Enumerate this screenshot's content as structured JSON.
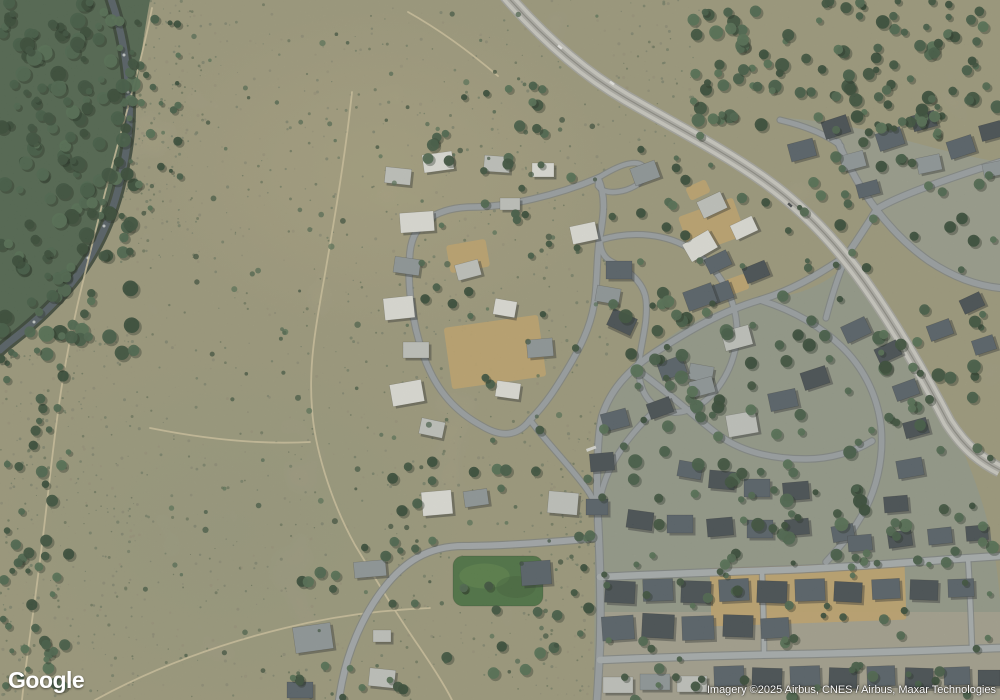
{
  "overlay": {
    "logo": "Google",
    "attribution": "Imagery ©2025 Airbus, CNES / Airbus, Maxar Technologies"
  },
  "map": {
    "width": 1000,
    "height": 700,
    "palette": {
      "scrub_base": "#ada789",
      "speckle": [
        "#79816b",
        "#8a8a74",
        "#657059",
        "#97927b",
        "#6e7a64"
      ],
      "forest_base": "#49614b",
      "tree_greens": [
        "#3a5540",
        "#314a37",
        "#44614a",
        "#2b4230",
        "#4c6a50"
      ],
      "river_water": "#4e5a64",
      "river_bank": "#2c3a30",
      "trail": "#d6c9a4",
      "dirt_lot": "#c4a76f",
      "field_green": "#45703f",
      "field_light": "#5f8c4d",
      "road_fill": "#9aa1a9",
      "road_fill_light": "#aab0b6",
      "road_casing": "#767d85",
      "highway_fill": "#d0d0cc",
      "highway_casing": "#a8a8a4",
      "highway_center": "#b2b2ae",
      "highway_line": "#8c8c88",
      "house_colors": [
        "#e8e9e5",
        "#c6cac8",
        "#8f989e",
        "#505c68",
        "#3d4750",
        "#c9ad76"
      ],
      "house_shadow": "rgba(25,30,35,0.4)",
      "vehicle_light": "#f2f2f2",
      "vehicle_dark": "#3e434a"
    },
    "ground": [
      {
        "path": "M 594,700 L 595,540 C 594,480 597,440 606,414 C 618,382 640,358 668,338 C 700,315 736,302 772,298 C 806,294 832,280 846,264 C 870,290 894,326 920,368 C 944,408 966,452 980,496 C 992,532 998,570 1000,600 L 1000,700 Z",
        "fill": "#949a8d",
        "opacity": 0.95
      },
      {
        "path": "M 788,118 C 830,122 870,130 905,140 C 940,150 975,158 1000,162 L 1000,285 C 975,282 950,273 926,259 C 905,246 888,228 874,210 C 862,190 850,166 838,144 Z",
        "fill": "#9aa092",
        "opacity": 0.9
      },
      {
        "path": "M 598,612 L 1000,612 L 1000,700 L 598,700 Z",
        "fill": "#a9a494",
        "opacity": 0.85
      }
    ],
    "forest": {
      "path": "M 0,0 L 150,0 C 142,42 138,88 128,130 C 119,166 111,200 97,236 C 84,268 60,296 36,318 C 20,333 8,344 0,352 Z",
      "fill": "#49614b"
    },
    "river": {
      "path": "M 110,-4 C 122,30 127,62 129,96 C 131,128 126,158 118,190 C 111,216 100,242 84,266 C 68,290 44,314 22,332 C 12,340 4,346 0,350",
      "water_width": 7,
      "bank_width": 13,
      "rapids": [
        [
          113,
          18
        ],
        [
          124,
          55
        ],
        [
          128,
          92
        ],
        [
          124,
          140
        ],
        [
          116,
          182
        ],
        [
          104,
          226
        ],
        [
          88,
          258
        ],
        [
          60,
          296
        ],
        [
          34,
          322
        ]
      ]
    },
    "trails": [
      "M 152,8 C 140,70 118,140 102,205 C 88,262 72,320 62,385 C 53,440 48,500 40,560 C 34,610 26,660 22,700",
      "M 352,92 C 346,150 336,210 326,268 C 318,315 308,360 312,408 C 314,445 330,500 355,545 C 375,578 395,612 420,648 C 432,666 444,684 452,700",
      "M 95,700 C 150,670 215,645 285,628 C 330,617 380,610 430,608",
      "M 150,428 C 200,438 255,445 310,442",
      "M 408,12 C 440,30 470,52 498,76"
    ],
    "dirt_lots": [
      [
        495,
        352,
        95,
        62,
        -8
      ],
      [
        712,
        226,
        58,
        40,
        -20
      ],
      [
        733,
        286,
        30,
        16,
        -20
      ],
      [
        698,
        190,
        22,
        14,
        -25
      ],
      [
        808,
        594,
        195,
        58,
        -2
      ],
      [
        468,
        256,
        40,
        28,
        -10
      ]
    ],
    "field": {
      "x": 453,
      "y": 556,
      "w": 90,
      "h": 50,
      "rx": 10
    },
    "roads": {
      "minor": [
        {
          "p": "M 598,178 C 556,196 505,207 474,207 C 441,207 413,220 410,252 C 407,282 411,320 424,357 C 437,393 458,413 482,426 C 502,438 518,436 530,420 C 546,404 556,388 568,368 C 580,348 590,328 594,305 C 598,282 596,258 600,236 C 604,214 606,196 598,178 Z",
          "w": 5.5
        },
        {
          "p": "M 598,178 C 614,168 634,158 643,166 C 651,174 641,185 626,190 C 612,194 602,192 598,186 Z",
          "w": 4.5
        },
        {
          "p": "M 530,420 C 548,444 570,466 586,488 C 594,499 597,508 598,520",
          "w": 5
        },
        {
          "p": "M 600,240 C 634,230 668,234 692,250 C 716,266 732,292 736,318 C 740,344 732,370 716,390 C 700,410 676,418 658,408 C 642,398 636,378 640,355 C 643,336 648,318 646,300 C 644,282 628,270 612,262 C 604,258 600,250 600,240",
          "w": 5
        },
        {
          "p": "M 658,408 C 640,424 618,448 606,478 C 600,494 598,506 598,520",
          "w": 5
        },
        {
          "p": "M 598,538 C 556,542 500,546 464,546 C 428,546 404,562 384,588 C 362,616 348,652 342,682 C 340,692 339,700 339,700",
          "w": 6,
          "f": "#a4abb2"
        },
        {
          "p": "M 598,520 C 600,560 601,610 600,645 C 599,668 598,685 597,700",
          "w": 6.5
        },
        {
          "p": "M 840,260 C 816,276 790,291 760,300 C 722,311 688,331 654,353 C 627,371 610,391 602,416 C 598,432 597,458 597,490 C 597,500 598,510 598,520",
          "w": 6
        },
        {
          "p": "M 760,300 C 792,310 820,326 841,346 C 862,366 877,393 881,426 C 884,458 877,492 859,520 C 849,537 836,551 826,562",
          "w": 5.5
        },
        {
          "p": "M 640,372 C 668,392 698,420 720,436 C 744,453 774,459 806,459 C 830,459 854,452 872,441",
          "w": 5.5
        },
        {
          "p": "M 600,577 C 660,574 720,572 780,570 C 840,568 900,563 955,559 C 970,558 986,557 1000,556",
          "w": 6.5,
          "f": "#aab0b6"
        },
        {
          "p": "M 600,660 C 668,657 736,655 804,654 C 870,653 936,650 1000,648",
          "w": 6.5,
          "f": "#aab0b6"
        },
        {
          "p": "M 762,571 C 763,600 764,628 764,655",
          "w": 4.5,
          "f": "#aab0b6"
        },
        {
          "p": "M 968,558 C 970,590 971,620 972,648",
          "w": 4.5,
          "f": "#aab0b6"
        },
        {
          "p": "M 838,142 C 850,170 862,191 876,209 C 891,229 909,247 929,261 C 956,279 980,286 1000,288",
          "w": 6
        },
        {
          "p": "M 845,258 C 860,236 869,222 877,209 C 896,197 940,181 1000,162",
          "w": 6
        },
        {
          "p": "M 780,120 C 810,127 830,137 841,146",
          "w": 5
        },
        {
          "p": "M 826,318 C 831,299 837,279 845,260",
          "w": 5
        }
      ],
      "highway": {
        "p": "M 505,-6 C 538,32 578,70 626,98 C 676,127 722,150 764,180 C 802,207 834,240 864,282 C 894,324 923,374 948,422 C 966,450 984,462 1000,470",
        "w": 12
      }
    },
    "houses": [
      [
        438,
        162,
        30,
        18,
        -8,
        0
      ],
      [
        497,
        164,
        26,
        16,
        4,
        1
      ],
      [
        543,
        170,
        22,
        14,
        0,
        0
      ],
      [
        645,
        173,
        26,
        18,
        -20,
        2
      ],
      [
        398,
        176,
        26,
        16,
        6,
        1
      ],
      [
        417,
        222,
        34,
        20,
        -4,
        0
      ],
      [
        407,
        266,
        26,
        16,
        8,
        2
      ],
      [
        399,
        308,
        30,
        22,
        -6,
        0
      ],
      [
        416,
        350,
        26,
        16,
        0,
        1
      ],
      [
        407,
        393,
        32,
        22,
        -10,
        0
      ],
      [
        432,
        428,
        24,
        16,
        12,
        1
      ],
      [
        468,
        270,
        24,
        16,
        -15,
        1
      ],
      [
        505,
        308,
        22,
        16,
        10,
        0
      ],
      [
        540,
        348,
        26,
        18,
        -5,
        2
      ],
      [
        508,
        390,
        24,
        16,
        8,
        0
      ],
      [
        510,
        204,
        20,
        12,
        0,
        1
      ],
      [
        584,
        233,
        26,
        18,
        -12,
        0
      ],
      [
        619,
        270,
        26,
        18,
        0,
        3
      ],
      [
        700,
        246,
        30,
        20,
        -30,
        0
      ],
      [
        719,
        293,
        26,
        18,
        -20,
        3
      ],
      [
        737,
        338,
        28,
        20,
        -15,
        1
      ],
      [
        701,
        373,
        24,
        16,
        10,
        2
      ],
      [
        712,
        205,
        26,
        18,
        -25,
        1
      ],
      [
        744,
        228,
        24,
        16,
        -25,
        0
      ],
      [
        437,
        503,
        30,
        24,
        -5,
        0
      ],
      [
        476,
        498,
        24,
        16,
        -8,
        2
      ],
      [
        563,
        503,
        30,
        22,
        5,
        1
      ],
      [
        597,
        507,
        22,
        16,
        0,
        3
      ],
      [
        370,
        569,
        32,
        16,
        -5,
        2
      ],
      [
        382,
        636,
        18,
        12,
        0,
        1
      ],
      [
        313,
        638,
        38,
        26,
        -8,
        2
      ],
      [
        382,
        678,
        26,
        18,
        6,
        1
      ],
      [
        300,
        690,
        26,
        16,
        0,
        3
      ],
      [
        536,
        573,
        30,
        24,
        -4,
        3
      ],
      [
        802,
        150,
        26,
        18,
        -15,
        3
      ],
      [
        836,
        127,
        26,
        18,
        -18,
        4
      ],
      [
        853,
        161,
        24,
        16,
        -15,
        2
      ],
      [
        890,
        139,
        26,
        18,
        -18,
        3
      ],
      [
        924,
        121,
        24,
        16,
        -15,
        4
      ],
      [
        929,
        164,
        24,
        16,
        -12,
        2
      ],
      [
        961,
        147,
        26,
        18,
        -18,
        3
      ],
      [
        991,
        131,
        22,
        16,
        -15,
        4
      ],
      [
        994,
        169,
        22,
        14,
        -12,
        2
      ],
      [
        868,
        189,
        22,
        14,
        -15,
        3
      ],
      [
        700,
        297,
        30,
        20,
        -20,
        3
      ],
      [
        608,
        295,
        24,
        16,
        10,
        2
      ],
      [
        622,
        322,
        26,
        18,
        25,
        4
      ],
      [
        615,
        420,
        26,
        18,
        -15,
        3
      ],
      [
        602,
        462,
        24,
        18,
        -5,
        4
      ],
      [
        672,
        368,
        26,
        18,
        -20,
        3
      ],
      [
        702,
        387,
        24,
        16,
        -15,
        2
      ],
      [
        660,
        408,
        24,
        16,
        -20,
        4
      ],
      [
        742,
        424,
        30,
        22,
        -10,
        1
      ],
      [
        783,
        400,
        28,
        18,
        -12,
        3
      ],
      [
        815,
        378,
        26,
        18,
        -18,
        4
      ],
      [
        718,
        262,
        24,
        16,
        -25,
        3
      ],
      [
        756,
        272,
        24,
        16,
        -22,
        4
      ],
      [
        856,
        330,
        26,
        18,
        -25,
        3
      ],
      [
        888,
        352,
        24,
        16,
        -25,
        4
      ],
      [
        906,
        390,
        24,
        16,
        -20,
        3
      ],
      [
        916,
        428,
        24,
        16,
        -15,
        4
      ],
      [
        910,
        468,
        26,
        18,
        -10,
        3
      ],
      [
        896,
        504,
        24,
        16,
        -5,
        4
      ],
      [
        690,
        470,
        24,
        16,
        10,
        3
      ],
      [
        722,
        480,
        26,
        18,
        5,
        4
      ],
      [
        757,
        488,
        26,
        18,
        0,
        3
      ],
      [
        796,
        491,
        26,
        18,
        -5,
        4
      ],
      [
        843,
        533,
        22,
        16,
        -10,
        3
      ],
      [
        640,
        520,
        26,
        18,
        8,
        4
      ],
      [
        680,
        524,
        26,
        18,
        0,
        3
      ],
      [
        720,
        527,
        26,
        18,
        -5,
        4
      ],
      [
        760,
        529,
        26,
        18,
        0,
        3
      ],
      [
        797,
        527,
        24,
        16,
        -5,
        4
      ],
      [
        940,
        330,
        24,
        16,
        -20,
        3
      ],
      [
        972,
        303,
        22,
        15,
        -25,
        4
      ],
      [
        984,
        345,
        22,
        15,
        -18,
        3
      ],
      [
        860,
        543,
        24,
        16,
        -5,
        3
      ],
      [
        900,
        539,
        24,
        16,
        -8,
        4
      ],
      [
        940,
        536,
        24,
        16,
        -6,
        3
      ],
      [
        977,
        533,
        22,
        15,
        -5,
        4
      ],
      [
        620,
        592,
        30,
        22,
        3,
        4
      ],
      [
        658,
        590,
        30,
        22,
        -2,
        3
      ],
      [
        696,
        592,
        30,
        22,
        2,
        4
      ],
      [
        734,
        590,
        30,
        22,
        -3,
        3
      ],
      [
        772,
        592,
        30,
        22,
        2,
        4
      ],
      [
        810,
        590,
        30,
        22,
        -2,
        3
      ],
      [
        848,
        592,
        28,
        20,
        3,
        4
      ],
      [
        886,
        589,
        28,
        20,
        -3,
        3
      ],
      [
        924,
        590,
        28,
        20,
        2,
        4
      ],
      [
        961,
        588,
        26,
        18,
        -2,
        3
      ],
      [
        618,
        628,
        32,
        24,
        -4,
        3
      ],
      [
        658,
        626,
        32,
        24,
        3,
        4
      ],
      [
        698,
        628,
        32,
        24,
        -2,
        3
      ],
      [
        738,
        626,
        30,
        22,
        2,
        4
      ],
      [
        775,
        628,
        28,
        20,
        -3,
        3
      ],
      [
        618,
        685,
        30,
        16,
        0,
        1
      ],
      [
        655,
        682,
        30,
        16,
        0,
        2
      ],
      [
        692,
        684,
        30,
        16,
        0,
        1
      ],
      [
        729,
        676,
        30,
        20,
        -2,
        3
      ],
      [
        767,
        678,
        30,
        20,
        2,
        4
      ],
      [
        805,
        676,
        30,
        20,
        -2,
        3
      ],
      [
        843,
        678,
        28,
        20,
        2,
        4
      ],
      [
        881,
        676,
        28,
        20,
        -2,
        3
      ],
      [
        919,
        678,
        28,
        20,
        2,
        4
      ],
      [
        957,
        676,
        26,
        18,
        -2,
        3
      ],
      [
        989,
        678,
        22,
        16,
        0,
        4
      ]
    ],
    "tree_regions": [
      [
        0,
        0,
        135,
        355,
        170,
        3,
        8
      ],
      [
        0,
        350,
        70,
        350,
        55,
        2.5,
        6
      ],
      [
        128,
        0,
        55,
        210,
        26,
        2,
        5
      ],
      [
        425,
        85,
        125,
        88,
        20,
        3,
        6
      ],
      [
        690,
        0,
        310,
        128,
        115,
        3,
        7
      ],
      [
        835,
        118,
        165,
        165,
        34,
        3,
        6
      ],
      [
        600,
        290,
        395,
        275,
        135,
        3,
        7
      ],
      [
        600,
        555,
        400,
        145,
        55,
        2.5,
        5.5
      ],
      [
        402,
        158,
        245,
        285,
        26,
        2.5,
        5
      ],
      [
        385,
        448,
        225,
        250,
        38,
        3,
        6
      ],
      [
        282,
        538,
        125,
        162,
        18,
        3,
        6
      ],
      [
        640,
        128,
        200,
        140,
        22,
        2.5,
        5.5
      ],
      [
        135,
        5,
        465,
        690,
        130,
        1.5,
        3.2
      ]
    ],
    "speckle_regions": [
      [
        125,
        0,
        490,
        700,
        900
      ],
      [
        0,
        320,
        135,
        380,
        330
      ],
      [
        615,
        0,
        85,
        145,
        80
      ],
      [
        540,
        430,
        60,
        270,
        90
      ],
      [
        118,
        0,
        85,
        265,
        150
      ]
    ],
    "vehicles": [
      [
        560,
        47,
        40,
        0
      ],
      [
        612,
        83,
        35,
        0
      ],
      [
        790,
        205,
        42,
        1
      ]
    ],
    "crosswalk": {
      "x": 586,
      "y": 449,
      "w": 10,
      "h": 3,
      "rot": -20
    }
  }
}
